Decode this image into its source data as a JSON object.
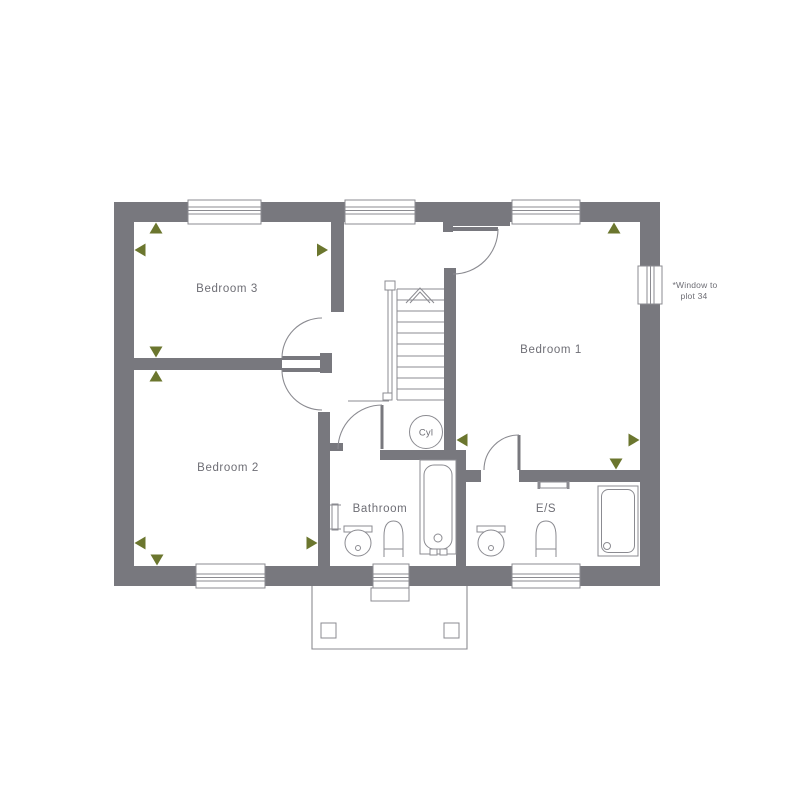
{
  "plan": {
    "rooms": [
      {
        "name": "bedroom-3",
        "label": "Bedroom 3"
      },
      {
        "name": "bedroom-2",
        "label": "Bedroom 2"
      },
      {
        "name": "bedroom-1",
        "label": "Bedroom 1"
      },
      {
        "name": "bathroom",
        "label": "Bathroom"
      },
      {
        "name": "ensuite",
        "label": "E/S"
      }
    ],
    "cylinder_label": "Cyl",
    "window_note": {
      "line1": "*Window to",
      "line2": "plot 34"
    },
    "colors": {
      "wall": "#78787e",
      "line": "#8b8b91",
      "text": "#6e6e75",
      "marker": "#6b762e",
      "bg": "#ffffff"
    }
  }
}
